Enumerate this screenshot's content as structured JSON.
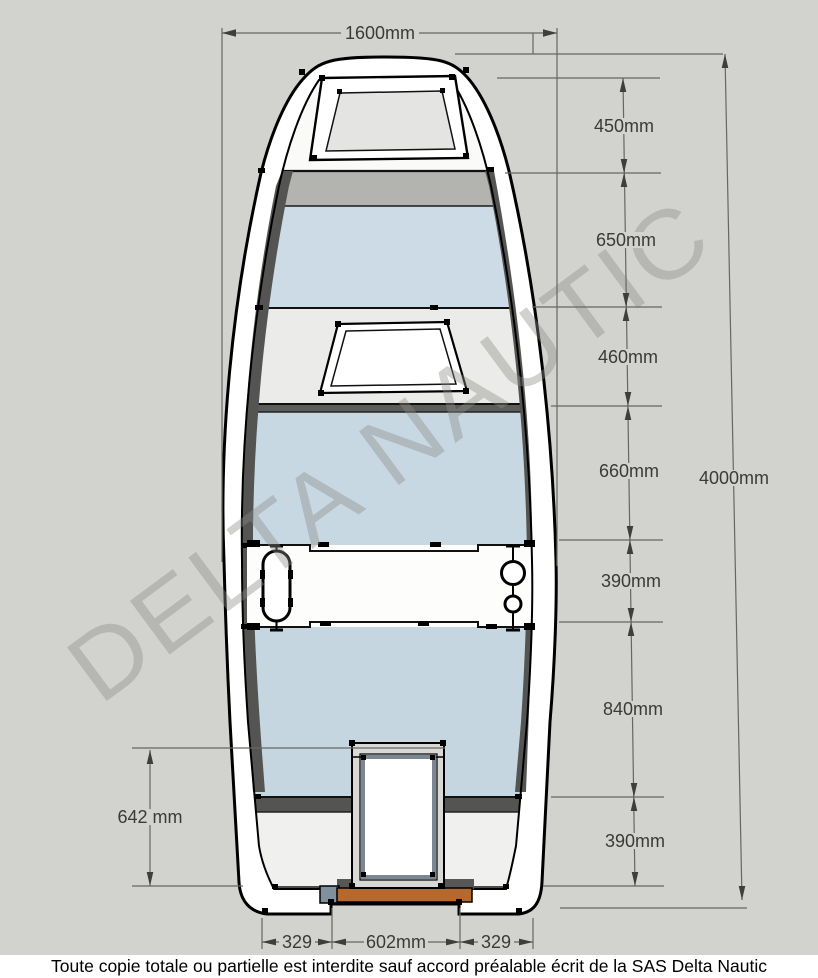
{
  "watermark": {
    "text": "DELTA NAUTIC"
  },
  "footer": {
    "notice": "Toute copie totale ou partielle est interdite sauf accord préalable écrit de la SAS Delta Nautic"
  },
  "dimensions": {
    "beam_width": {
      "label": "1600mm",
      "value_mm": 1600
    },
    "overall_length": {
      "label": "4000mm",
      "value_mm": 4000
    },
    "right_segments": [
      {
        "label": "450mm",
        "value_mm": 450
      },
      {
        "label": "650mm",
        "value_mm": 650
      },
      {
        "label": "460mm",
        "value_mm": 460
      },
      {
        "label": "660mm",
        "value_mm": 660
      },
      {
        "label": "390mm",
        "value_mm": 390
      },
      {
        "label": "840mm",
        "value_mm": 840
      },
      {
        "label": "390mm",
        "value_mm": 390
      }
    ],
    "stern_well_length": {
      "label": "642 mm",
      "value_mm": 642
    },
    "transom_segments": [
      {
        "label": "329",
        "value_mm": 329
      },
      {
        "label": "602mm",
        "value_mm": 602
      },
      {
        "label": "329",
        "value_mm": 329
      }
    ]
  },
  "colors": {
    "background": "#d2d2ce",
    "hull_white": "#ffffff",
    "floor_blue": "#c8d8e3",
    "deck_gray": "#ebebe9",
    "bow_bulkhead_gray": "#b3b3b0",
    "wall_dark_gray": "#545452",
    "hatch_lid_gray": "#e4e4e2",
    "well_frame_gray": "#7b8894",
    "transom_wood_orange": "#b5692f",
    "transom_fitting_steel": "#7f919d",
    "dimension_text": "#3a3a38"
  }
}
